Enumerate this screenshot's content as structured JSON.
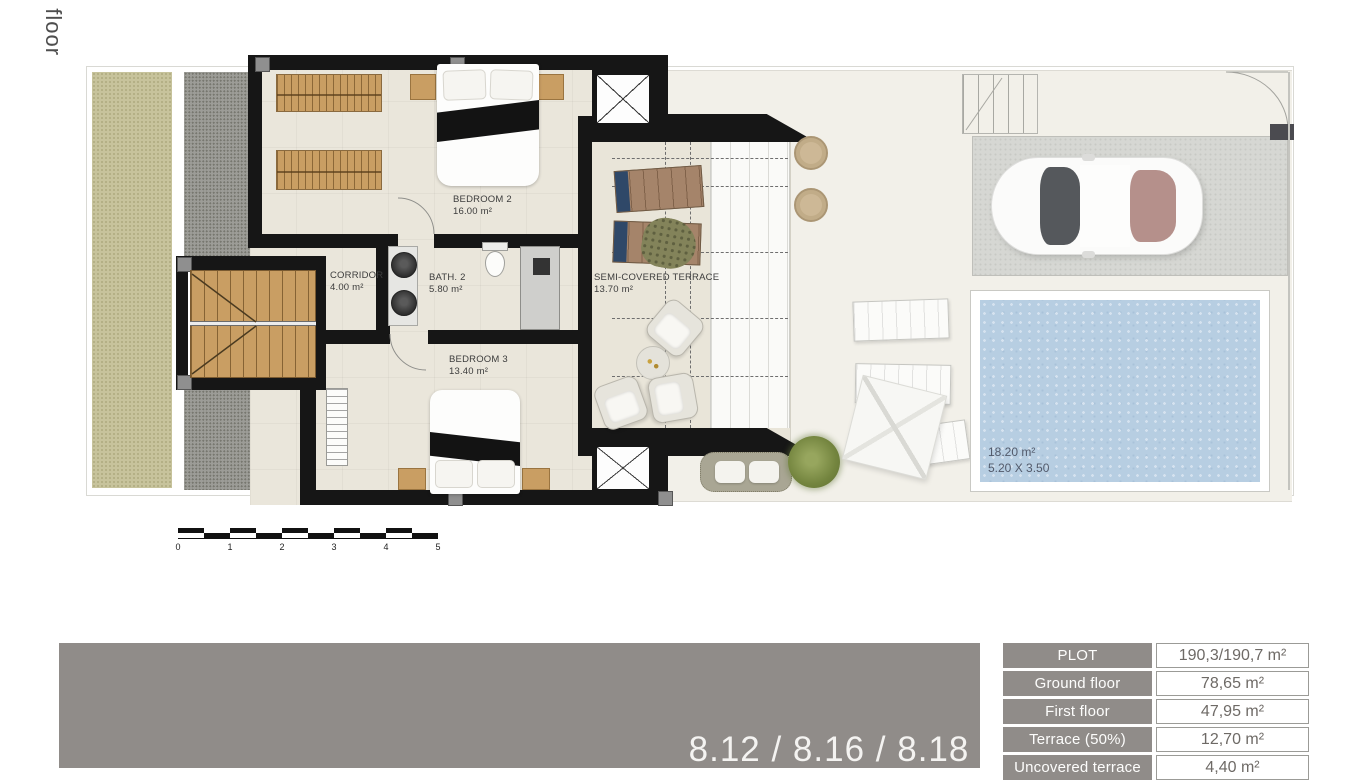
{
  "page": {
    "vertical_title": "t floor"
  },
  "plan": {
    "rooms": [
      {
        "name": "BEDROOM 2",
        "area": "16.00 m²"
      },
      {
        "name": "CORRIDOR",
        "area": "4.00 m²"
      },
      {
        "name": "BATH. 2",
        "area": "5.80 m²"
      },
      {
        "name": "BEDROOM 3",
        "area": "13.40 m²"
      },
      {
        "name": "SEMI-COVERED TERRACE",
        "area": "13.70 m²"
      }
    ],
    "pool": {
      "area": "18.20 m²",
      "dimensions": "5.20 X 3.50"
    },
    "scale_bar": {
      "ticks": [
        "0",
        "1",
        "2",
        "3",
        "4",
        "5"
      ]
    }
  },
  "banner": {
    "unit_numbers": "8.12 / 8.16 / 8.18",
    "color": "#908c89"
  },
  "summary_table": {
    "rows": [
      {
        "label": "PLOT",
        "value": "190,3/190,7 m²"
      },
      {
        "label": "Ground floor",
        "value": "78,65 m²"
      },
      {
        "label": "First floor",
        "value": "47,95 m²"
      },
      {
        "label": "Terrace (50%)",
        "value": "12,70 m²"
      },
      {
        "label": "Uncovered terrace",
        "value": "4,40 m²"
      }
    ]
  }
}
